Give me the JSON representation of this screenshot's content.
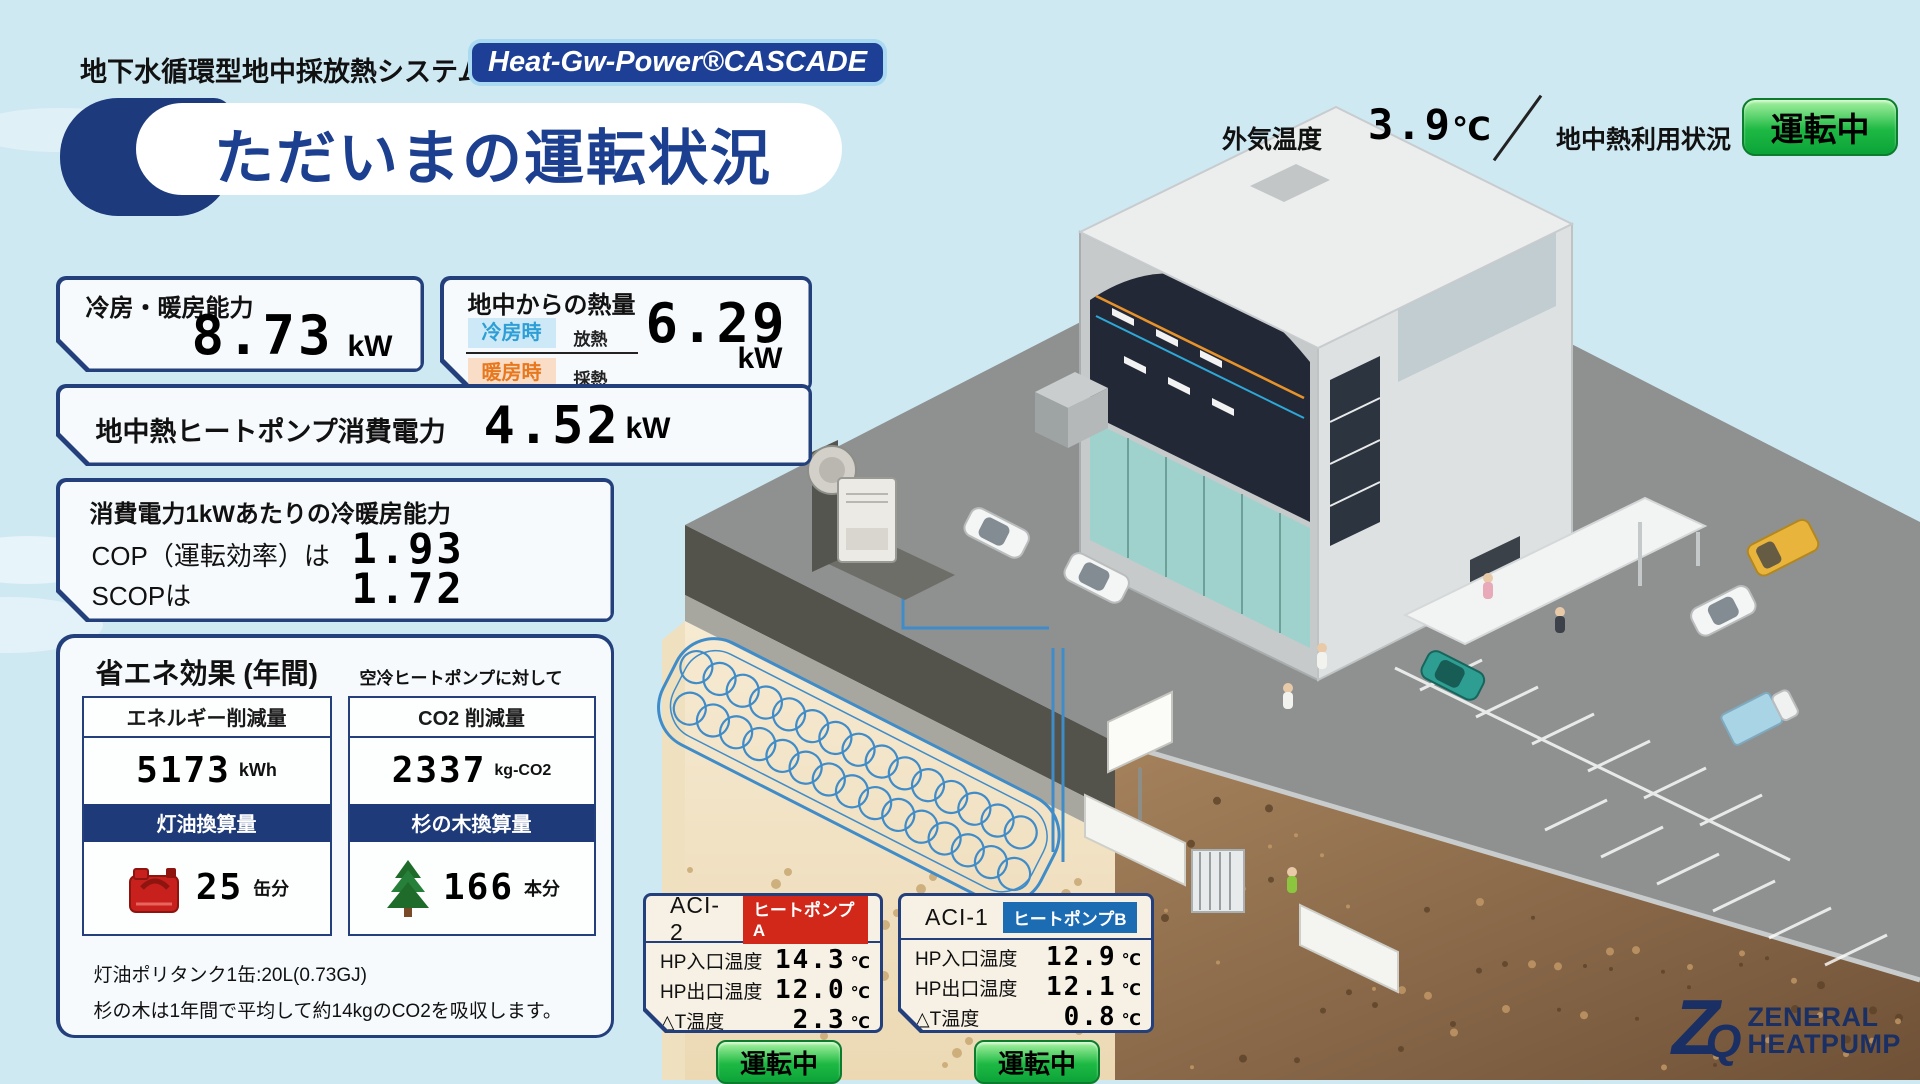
{
  "header": {
    "system_label": "地下水循環型地中採放熱システム",
    "brand_badge": "Heat-Gw-Power®CASCADE",
    "title": "ただいまの運転状況",
    "outdoor": {
      "label": "外気温度",
      "value": "3.9",
      "unit": "℃"
    },
    "geo": {
      "label": "地中熱利用状況",
      "status": "運転中"
    }
  },
  "panels": {
    "capacity": {
      "label": "冷房・暖房能力",
      "value": "8.73",
      "unit": "kW"
    },
    "ground_heat": {
      "label": "地中からの熱量",
      "rows": [
        {
          "badge": "冷房時",
          "mode": "放熱"
        },
        {
          "badge": "暖房時",
          "mode": "採熱"
        }
      ],
      "value": "6.29",
      "unit": "kW"
    },
    "hp_power": {
      "label": "地中熱ヒートポンプ消費電力",
      "value": "4.52",
      "unit": "kW"
    },
    "efficiency": {
      "title": "消費電力1kWあたりの冷暖房能力",
      "rows": [
        {
          "label": "COP（運転効率）は",
          "value": "1.93"
        },
        {
          "label": "SCOPは",
          "value": "1.72"
        }
      ]
    },
    "savings": {
      "title": "省エネ効果 (年間)",
      "subtitle": "空冷ヒートポンプに対して",
      "columns": [
        {
          "header": "エネルギー削減量",
          "value": "5173",
          "unit": "kWh",
          "band": "灯油換算量",
          "icon": "kerosene-can-icon",
          "equiv_value": "25",
          "equiv_unit": "缶分"
        },
        {
          "header": "CO2 削減量",
          "value": "2337",
          "unit": "kg-CO2",
          "band": "杉の木換算量",
          "icon": "cedar-tree-icon",
          "equiv_value": "166",
          "equiv_unit": "本分"
        }
      ],
      "notes": [
        "灯油ポリタンク1缶:20L(0.73GJ)",
        "杉の木は1年間で平均して約14kgのCO2を吸収します。"
      ]
    }
  },
  "heat_pumps": [
    {
      "id": "ACI-2",
      "badge": "ヒートポンプA",
      "badge_color": "#d2281a",
      "rows": [
        {
          "label": "HP入口温度",
          "value": "14.3",
          "unit": "℃"
        },
        {
          "label": "HP出口温度",
          "value": "12.0",
          "unit": "℃"
        },
        {
          "label": "△T温度",
          "value": "2.3",
          "unit": "℃"
        }
      ],
      "status": "運転中"
    },
    {
      "id": "ACI-1",
      "badge": "ヒートポンプB",
      "badge_color": "#1c6cb4",
      "rows": [
        {
          "label": "HP入口温度",
          "value": "12.9",
          "unit": "℃"
        },
        {
          "label": "HP出口温度",
          "value": "12.1",
          "unit": "℃"
        },
        {
          "label": "△T温度",
          "value": "0.8",
          "unit": "℃"
        }
      ],
      "status": "運転中"
    }
  ],
  "logo": {
    "mark_z": "Z",
    "mark_q": "Q",
    "line1": "ZENERAL",
    "line2": "HEATPUMP"
  },
  "colors": {
    "navy": "#23407c",
    "sky": "#cfe9f3",
    "panel_bg": "#f6fafd",
    "status_green": "#1eb944",
    "cooling_badge_bg": "#cde9f7",
    "cooling_badge_text": "#2d9fd6",
    "heating_badge_bg": "#f9ddc7",
    "heating_badge_text": "#e8781e",
    "pipe_blue": "#3f8cc9"
  }
}
